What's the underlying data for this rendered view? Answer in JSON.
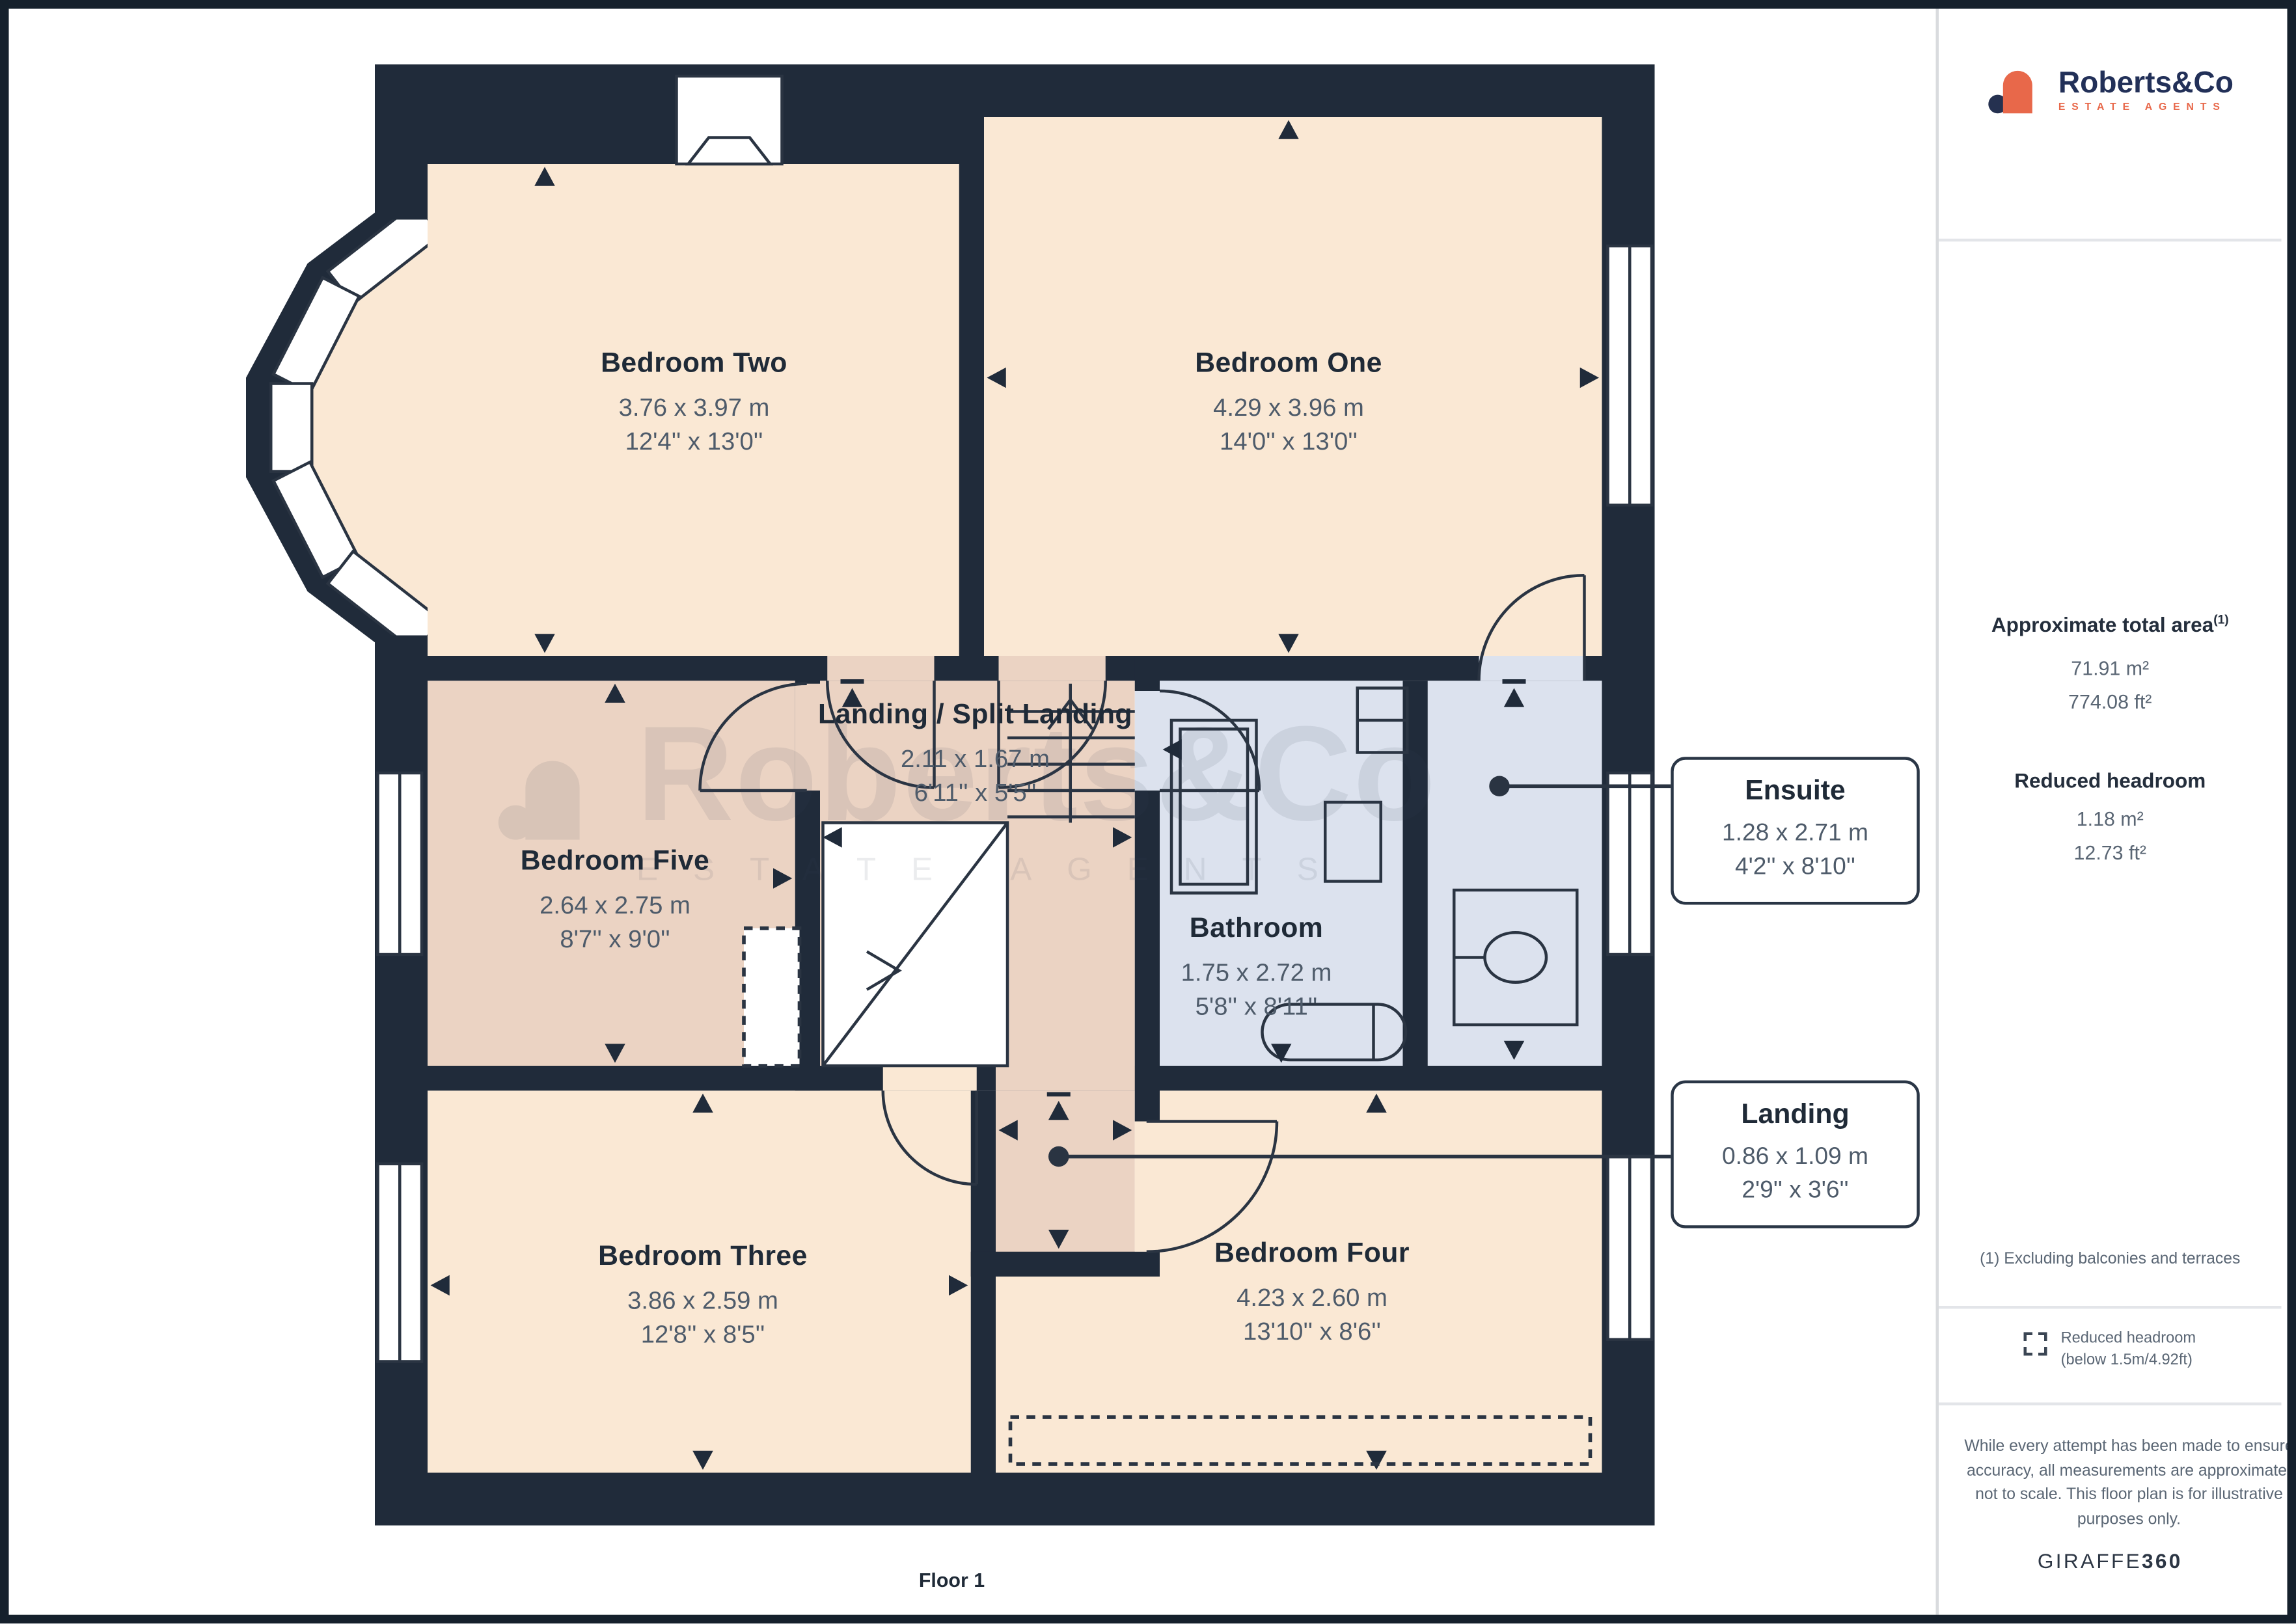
{
  "plan": {
    "floor_label": "Floor 1",
    "rooms": [
      {
        "id": "bedroom-two",
        "name": "Bedroom Two",
        "size_metric": "3.76 x 3.97 m",
        "size_imperial": "12'4'' x 13'0''"
      },
      {
        "id": "bedroom-one",
        "name": "Bedroom One",
        "size_metric": "4.29 x 3.96 m",
        "size_imperial": "14'0'' x 13'0''"
      },
      {
        "id": "landing-split-landing",
        "name": "Landing / Split Landing",
        "size_metric": "2.11 x 1.67 m",
        "size_imperial": "6'11'' x 5'5''"
      },
      {
        "id": "bedroom-five",
        "name": "Bedroom Five",
        "size_metric": "2.64 x 2.75 m",
        "size_imperial": "8'7'' x 9'0''"
      },
      {
        "id": "bathroom",
        "name": "Bathroom",
        "size_metric": "1.75 x 2.72 m",
        "size_imperial": "5'8'' x 8'11''"
      },
      {
        "id": "bedroom-three",
        "name": "Bedroom Three",
        "size_metric": "3.86 x 2.59 m",
        "size_imperial": "12'8'' x 8'5''"
      },
      {
        "id": "bedroom-four",
        "name": "Bedroom Four",
        "size_metric": "4.23 x 2.60 m",
        "size_imperial": "13'10'' x 8'6''"
      }
    ],
    "callouts": [
      {
        "id": "ensuite",
        "name": "Ensuite",
        "size_metric": "1.28 x 2.71 m",
        "size_imperial": "4'2'' x 8'10''"
      },
      {
        "id": "landing",
        "name": "Landing",
        "size_metric": "0.86 x 1.09 m",
        "size_imperial": "2'9'' x 3'6''"
      }
    ]
  },
  "watermark": {
    "brand": "Roberts&Co",
    "tagline": "ESTATE AGENTS"
  },
  "sidebar": {
    "logo": {
      "brand": "Roberts&Co",
      "tagline": "ESTATE AGENTS"
    },
    "total_area": {
      "heading": "Approximate total area",
      "footnote_marker": "(1)",
      "metric": "71.91 m²",
      "imperial": "774.08 ft²"
    },
    "reduced_headroom": {
      "heading": "Reduced headroom",
      "metric": "1.18 m²",
      "imperial": "12.73 ft²"
    },
    "footnote": "(1) Excluding balconies and terraces",
    "legend": {
      "label": "Reduced headroom",
      "sublabel": "(below 1.5m/4.92ft)"
    },
    "disclaimer": "While every attempt has been made to ensure accuracy, all measurements are approximate, not to scale. This floor plan is for illustrative purposes only.",
    "credit": {
      "regular": "GIRAFFE",
      "bold": "360"
    }
  },
  "colors": {
    "wall": "#202b3a",
    "room_peach": "#fae8d4",
    "room_tan": "#ebd3c3",
    "room_blue": "#dce2ee",
    "accent_orange": "#e8684a",
    "brand_navy": "#223058",
    "text_dark": "#1f2a37",
    "text_dim": "#4e5b6a"
  }
}
